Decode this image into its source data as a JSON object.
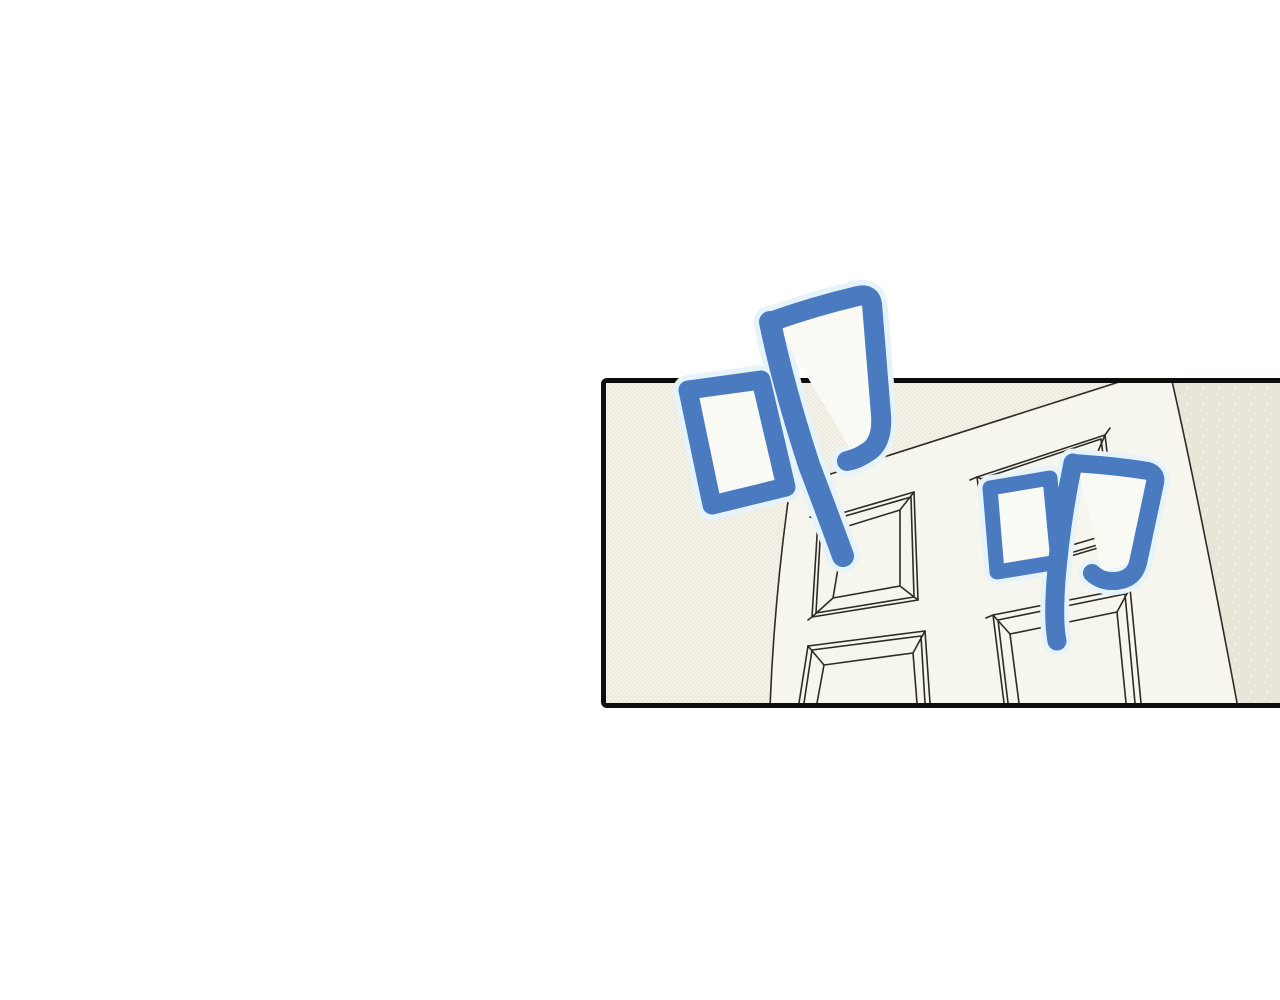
{
  "panel": {
    "kind": "comic-panel",
    "content": "tilted perspective view of a white four-panel door between two walls"
  },
  "sfx": {
    "combined": "叩叩",
    "items": [
      {
        "char": "叩",
        "label": "knock-sfx-large"
      },
      {
        "char": "叩",
        "label": "knock-sfx-small"
      }
    ]
  },
  "colors": {
    "sfx_blue": "#4a7abf",
    "sfx_glow": "#e7f3fb",
    "line_ink": "#2e2b26",
    "panel_border": "#0d0d0d",
    "wall_left": "#eeebdf",
    "wall_right": "#e9e6d9",
    "door": "#f7f6ee",
    "page_bg": "#ffffff",
    "glyph_fill": "#f9faf4"
  }
}
